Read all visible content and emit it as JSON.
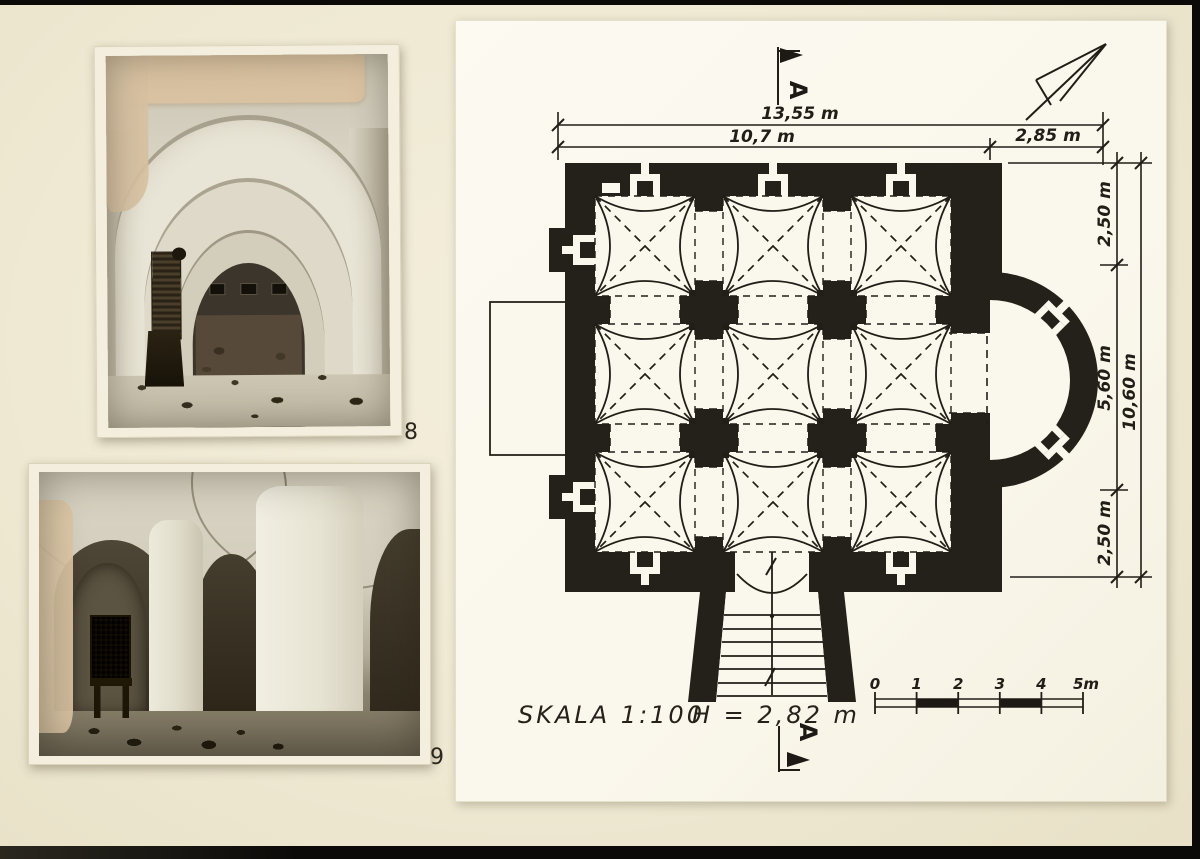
{
  "photos": [
    {
      "label": "8"
    },
    {
      "label": "9"
    }
  ],
  "plan": {
    "section_marker": "A",
    "dimensions": {
      "top_total": "13,55 m",
      "top_left": "10,7 m",
      "top_right": "2,85 m",
      "right_top": "2,50 m",
      "right_mid": "5,60 m",
      "right_bottom": "2,50 m",
      "right_total": "10,60 m"
    },
    "scale_label": "SKALA  1:100",
    "height_label": "H = 2,82 m",
    "scale_bar": {
      "labels": [
        "0",
        "1",
        "2",
        "3",
        "4",
        "5m"
      ]
    },
    "colors": {
      "wall_ink": "#24211a",
      "line_ink": "#211e18",
      "paper": "#faf7ec",
      "page_background": "#efe9d3",
      "photo_mount": "#f3eedd",
      "photo_sepia_light": "#d8d3c3",
      "photo_sepia_dark": "#352e21",
      "damage_patch": "#d9c2a1"
    }
  }
}
